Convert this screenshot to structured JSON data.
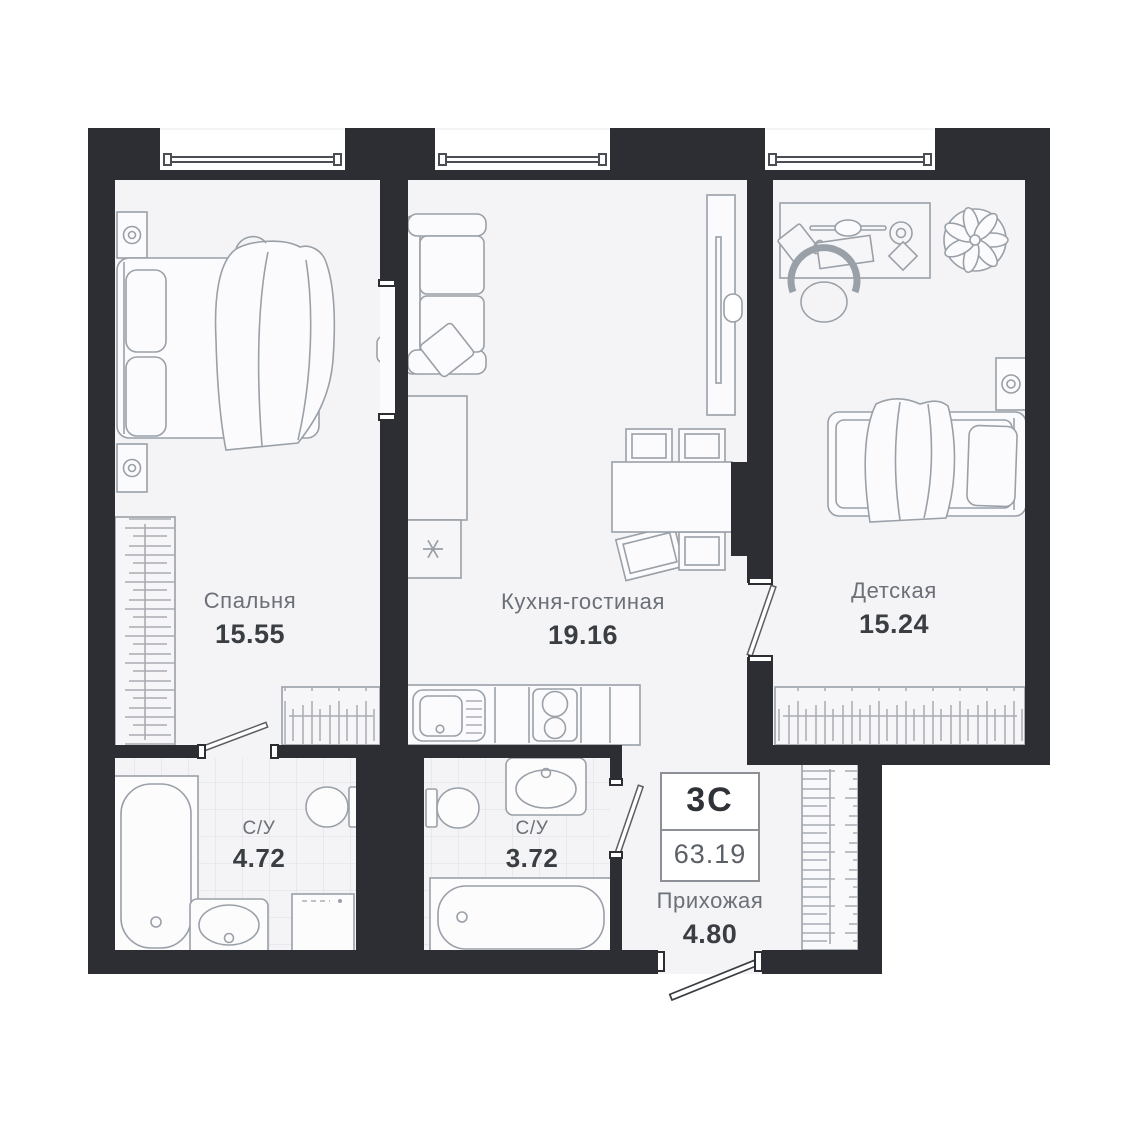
{
  "floorplan": {
    "badge": {
      "layout_type": "3С",
      "total_area": "63.19"
    },
    "rooms": [
      {
        "name": "Спальня",
        "area": "15.55"
      },
      {
        "name": "Кухня-гостиная",
        "area": "19.16"
      },
      {
        "name": "Детская",
        "area": "15.24"
      },
      {
        "name": "С/У",
        "area": "4.72"
      },
      {
        "name": "С/У",
        "area": "3.72"
      },
      {
        "name": "Прихожая",
        "area": "4.80"
      }
    ],
    "icons": {
      "fridge_symbol": "snowflake-icon",
      "wardrobe_symbol": "hanging-rail-icon",
      "shaft_symbol": "diagonal-hatch-icon"
    },
    "colors": {
      "wall": "#2c2e33",
      "floor": "#f4f4f6",
      "furniture_outline": "#9aa0a8",
      "text_primary": "#3a3d42",
      "text_secondary": "#6b6f77"
    }
  }
}
